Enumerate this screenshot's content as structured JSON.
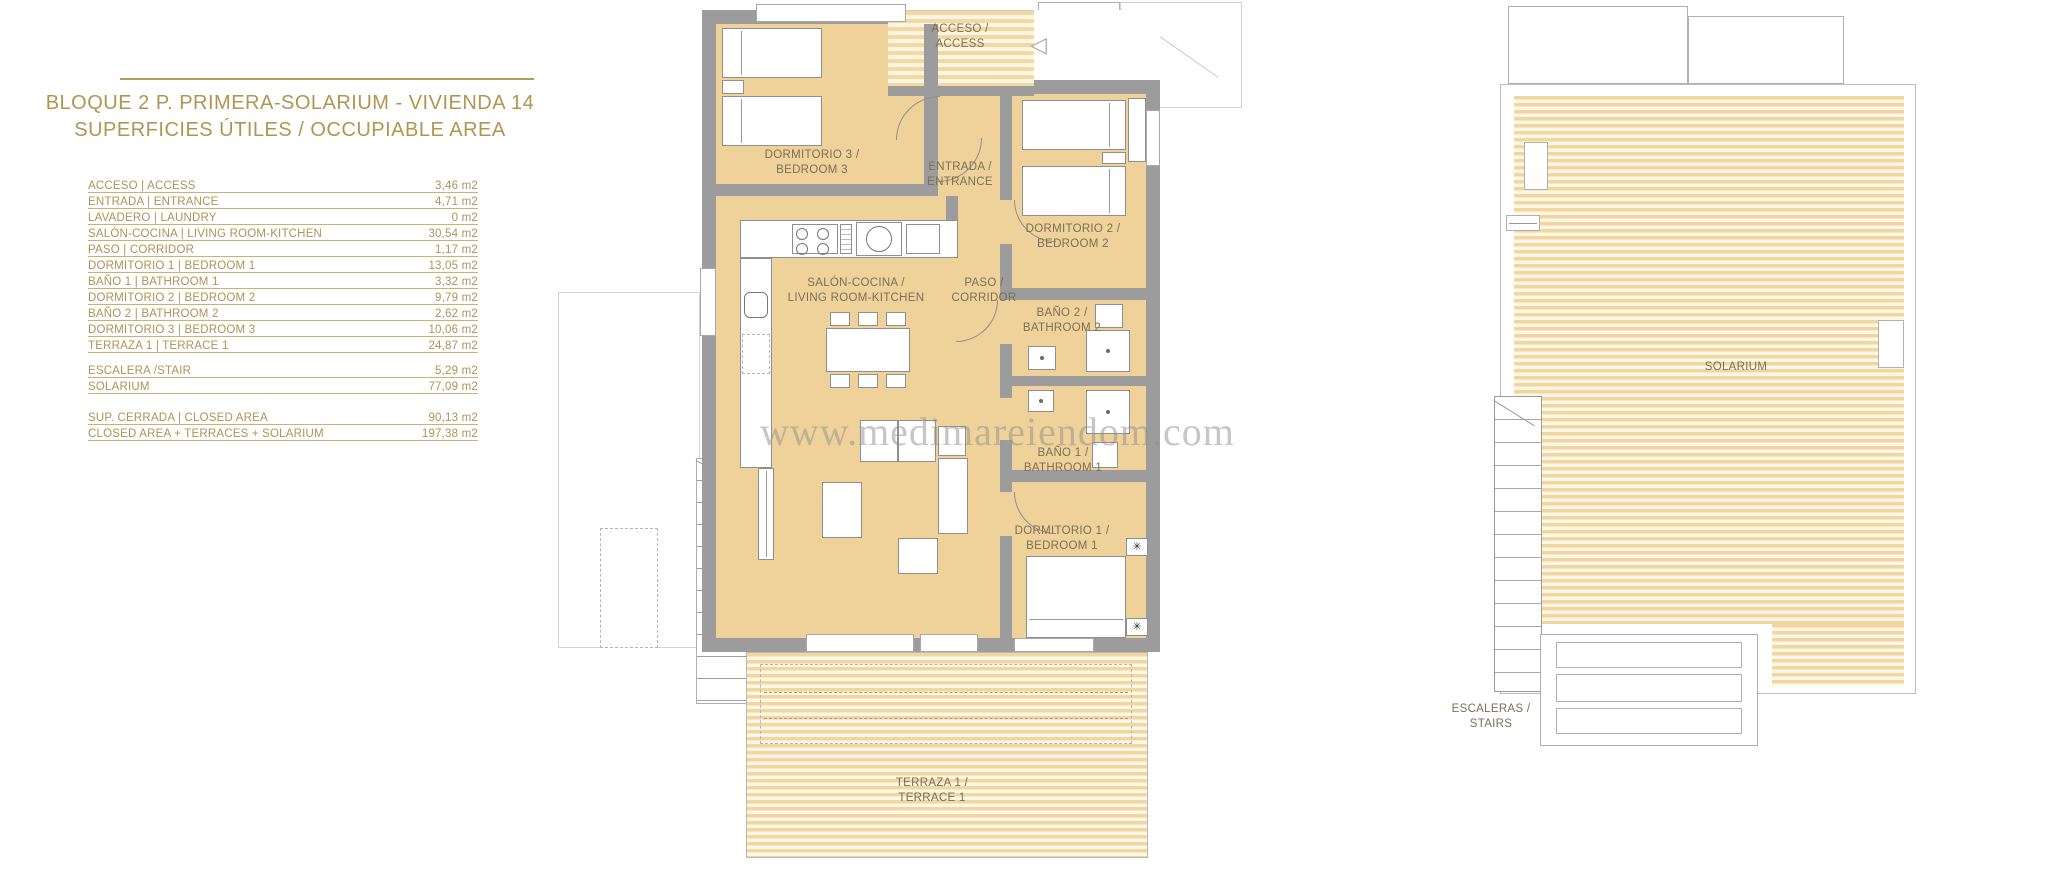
{
  "title": {
    "line1": "BLOQUE 2 P. PRIMERA-SOLARIUM - VIVIENDA 14",
    "line2": "SUPERFICIES ÚTILES / OCCUPIABLE AREA"
  },
  "areas_table": {
    "rows": [
      {
        "label": "ACCESO | ACCESS",
        "value": "3,46 m2"
      },
      {
        "label": "ENTRADA | ENTRANCE",
        "value": "4,71 m2"
      },
      {
        "label": "LAVADERO | LAUNDRY",
        "value": "0 m2"
      },
      {
        "label": "SALÓN-COCINA | LIVING ROOM-KITCHEN",
        "value": "30,54 m2"
      },
      {
        "label": "PASO | CORRIDOR",
        "value": "1,17 m2"
      },
      {
        "label": "DORMITORIO 1 | BEDROOM 1",
        "value": "13,05 m2"
      },
      {
        "label": "BAÑO 1 | BATHROOM 1",
        "value": "3,32 m2"
      },
      {
        "label": "DORMITORIO 2 | BEDROOM 2",
        "value": "9,79 m2"
      },
      {
        "label": "BAÑO 2 | BATHROOM 2",
        "value": "2,62 m2"
      },
      {
        "label": "DORMITORIO 3 | BEDROOM 3",
        "value": "10,06 m2"
      },
      {
        "label": "TERRAZA 1 | TERRACE 1",
        "value": "24,87 m2"
      }
    ],
    "secondary_rows": [
      {
        "label": "ESCALERA /STAIR",
        "value": "5,29 m2"
      },
      {
        "label": "SOLARIUM",
        "value": "77,09 m2"
      }
    ],
    "summary_rows": [
      {
        "label": "SUP. CERRADA | CLOSED AREA",
        "value": "90,13 m2"
      },
      {
        "label": "CLOSED AREA + TERRACES + SOLARIUM",
        "value": "197,38 m2"
      }
    ]
  },
  "floor_plan": {
    "labels": {
      "acceso": "ACCESO /\nACCESS",
      "dormitorio3": "DORMITORIO 3 /\nBEDROOM 3",
      "entrada": "ENTRADA /\nENTRANCE",
      "dormitorio2": "DORMITORIO 2 /\nBEDROOM 2",
      "salon_cocina": "SALÓN-COCINA /\nLIVING ROOM-KITCHEN",
      "paso": "PASO /\nCORRIDOR",
      "bano2": "BAÑO 2 /\nBATHROOM 2",
      "bano1": "BAÑO 1 /\nBATHROOM 1",
      "dormitorio1": "DORMITORIO 1 /\nBEDROOM 1",
      "terraza": "TERRAZA 1 /\nTERRACE 1"
    }
  },
  "solarium_plan": {
    "labels": {
      "solarium": "SOLARIUM",
      "escaleras": "ESCALERAS /\nSTAIRS"
    }
  },
  "watermark": "www.medimareiendom.com",
  "icons": {
    "lamp": "✳",
    "access_arrow": "◁"
  },
  "colors": {
    "accent_gold": "#b09650",
    "room_fill": "#efd29a",
    "wall_gray": "#9c9c9c",
    "hatch_stripe": "#f3d9a1",
    "label_brown": "#7b6f57"
  }
}
